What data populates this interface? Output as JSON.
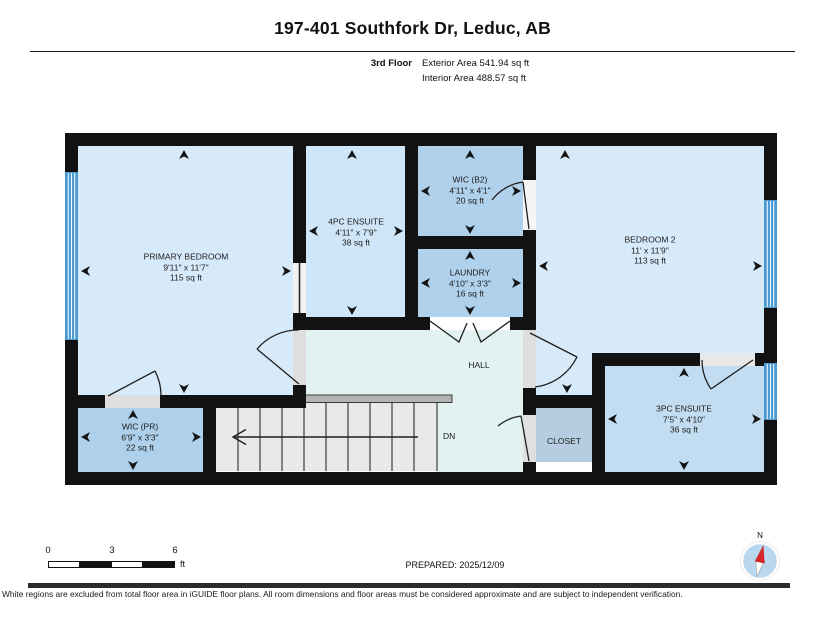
{
  "header": {
    "title": "197-401 Southfork Dr, Leduc, AB",
    "floor_label": "3rd Floor",
    "exterior_area": "Exterior Area 541.94 sq ft",
    "interior_area": "Interior Area 488.57 sq ft"
  },
  "plan": {
    "rooms": {
      "primary_bedroom": {
        "name": "PRIMARY BEDROOM",
        "dims": "9'11\" x 11'7\"",
        "area": "115 sq ft"
      },
      "ensuite_4pc": {
        "name": "4PC ENSUITE",
        "dims": "4'11\" x 7'9\"",
        "area": "38 sq ft"
      },
      "wic_b2": {
        "name": "WIC (B2)",
        "dims": "4'11\" x 4'1\"",
        "area": "20 sq ft"
      },
      "laundry": {
        "name": "LAUNDRY",
        "dims": "4'10\" x 3'3\"",
        "area": "16 sq ft"
      },
      "bedroom_2": {
        "name": "BEDROOM 2",
        "dims": "11' x 11'9\"",
        "area": "113 sq ft"
      },
      "hall": {
        "name": "HALL"
      },
      "wic_pr": {
        "name": "WIC (PR)",
        "dims": "6'9\" x 3'3\"",
        "area": "22 sq ft"
      },
      "closet": {
        "name": "CLOSET"
      },
      "ensuite_3pc": {
        "name": "3PC ENSUITE",
        "dims": "7'5\" x 4'10\"",
        "area": "36 sq ft"
      }
    },
    "stairs": {
      "label": "DN"
    }
  },
  "footer": {
    "scale": {
      "ticks": [
        "0",
        "3",
        "6"
      ],
      "unit": "ft"
    },
    "prepared": "PREPARED: 2025/12/09",
    "compass_label": "N",
    "disclaimer": "White regions are excluded from total floor area in iGUIDE floor plans. All room dimensions and floor areas must be considered approximate and are subject to independent verification."
  },
  "colors": {
    "wall": "#121212",
    "room_light_blue": "#d7eafa",
    "room_medium_blue": "#afd1ec",
    "ensuite_3pc_blue": "#c2ddf2",
    "closet_blue": "#b6cde1",
    "hall": "#e1f2f1",
    "window": "#4a98d3",
    "stairs": "#e9e9e9",
    "compass_needle": "#d3282a",
    "footer_bar": "#2b2b2b"
  }
}
